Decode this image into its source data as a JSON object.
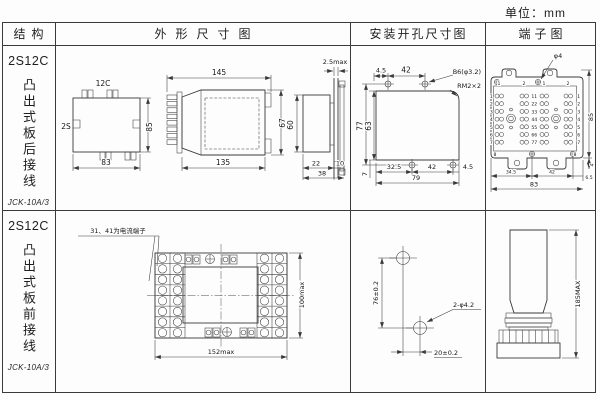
{
  "unit_label": "单位：mm",
  "headers": {
    "structure": "结构",
    "outline": "外形尺寸图",
    "mounting": "安装开孔尺寸图",
    "terminal": "端子图"
  },
  "row1": {
    "model": "2S12C",
    "type_vertical": "凸出式板后接线",
    "product": "JCK-10A/3"
  },
  "row2": {
    "model": "2S12C",
    "type_vertical": "凸出式板前接线",
    "product": "JCK-10A/3"
  },
  "outline_rear": {
    "front": {
      "top_label": "12C",
      "side_label": "2S",
      "h": "85",
      "w": "83"
    },
    "side": {
      "top": "145",
      "h": "67",
      "bottom": "135"
    },
    "panel": {
      "t": "2.5max",
      "h": "60",
      "a": "22",
      "b": "10",
      "total": "38"
    }
  },
  "mount_rear": {
    "top_a": "4.5",
    "top_b": "42",
    "hole": "B6(φ3.2)",
    "screw": "RM2×2",
    "left_a": "77",
    "left_b": "63",
    "b7": "7",
    "bottom_a": "32.5",
    "bottom_b": "42",
    "bottom_c": "4.5",
    "total": "79"
  },
  "terminal_rear": {
    "hole": "φ4",
    "right_h": "85",
    "right_d": "4",
    "bottom_a": "34.5",
    "bottom_b": "42",
    "bottom_c": "6.5",
    "total": "83",
    "top_nums": [
      "1",
      "2",
      "1",
      "2"
    ],
    "rows": [
      "1",
      "2",
      "3",
      "4",
      "5",
      "6",
      "7"
    ],
    "centers": [
      "11",
      "22",
      "33",
      "44",
      "55",
      "66",
      "77"
    ],
    "bottom_nums": [
      "8",
      "8"
    ]
  },
  "outline_front": {
    "note": "31、41为电流端子",
    "h": "100max",
    "w": "152max"
  },
  "mount_front": {
    "v": "76±0.2",
    "label": "2-φ4.2",
    "h": "20±0.2"
  },
  "terminal_front": {
    "h": "185MAX"
  }
}
